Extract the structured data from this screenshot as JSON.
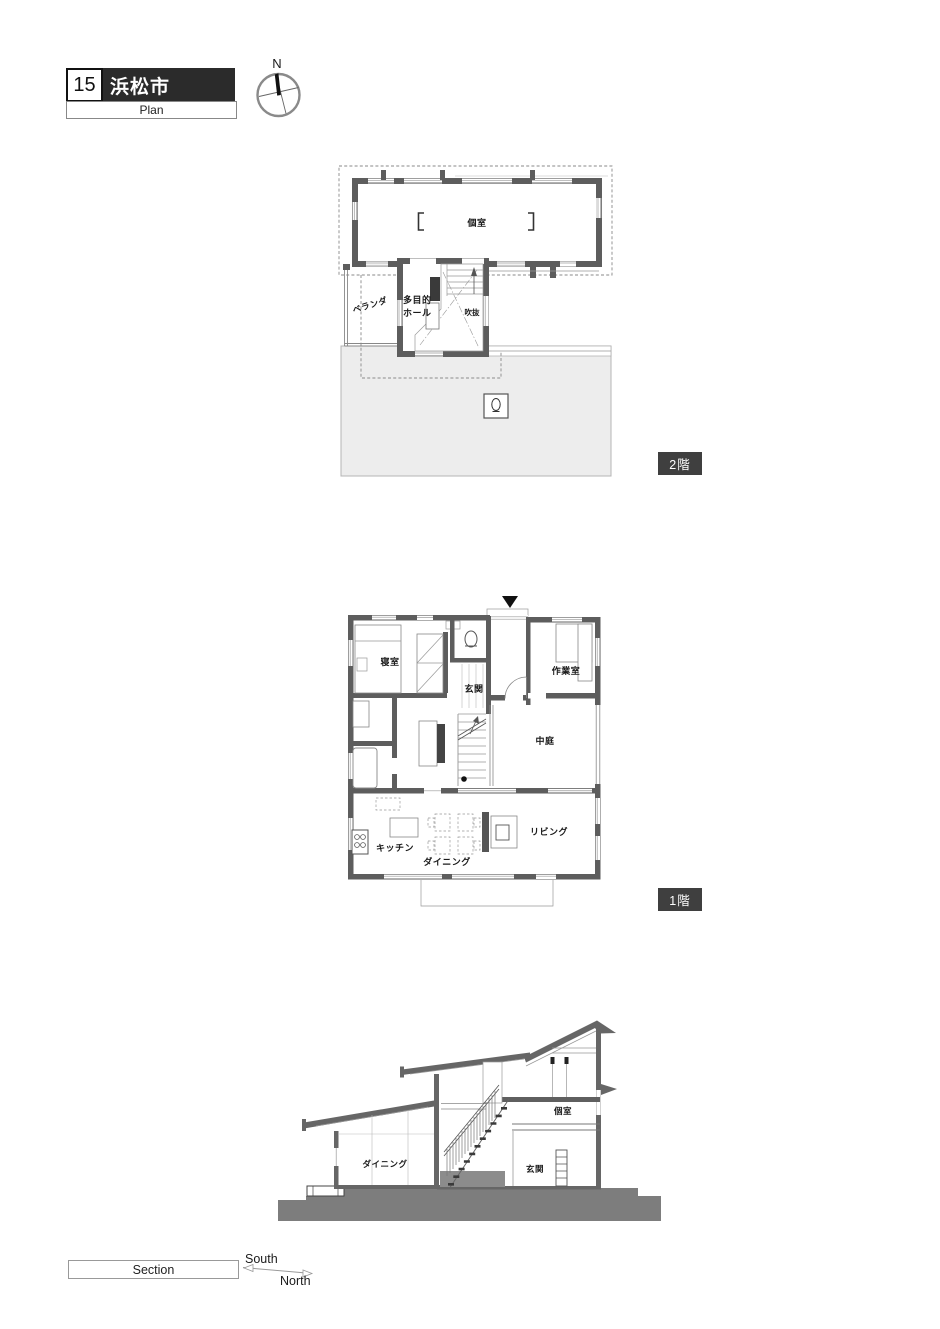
{
  "title": {
    "number": "15",
    "city": "浜松市",
    "sheet": "Plan"
  },
  "compass": {
    "north": "N"
  },
  "floor2": {
    "badge": "2階",
    "rooms": {
      "private_room": "個室",
      "hall_line1": "多目的",
      "hall_line2": "ホール",
      "void": "吹抜",
      "veranda": "ベランダ"
    }
  },
  "floor1": {
    "badge": "1階",
    "rooms": {
      "bedroom": "寝室",
      "entrance": "玄関",
      "workroom": "作業室",
      "courtyard": "中庭",
      "kitchen": "キッチン",
      "dining": "ダイニング",
      "living": "リビング"
    }
  },
  "section": {
    "sheet": "Section",
    "south": "South",
    "north": "North",
    "rooms": {
      "dining": "ダイニング",
      "entrance": "玄関",
      "private_room": "個室"
    }
  },
  "colors": {
    "wall": "#5d5d5d",
    "roof_shade": "#ededed",
    "ground": "#7d7d7d",
    "badge_bg": "#3f3f3f",
    "header_bg": "#2b2b2b"
  }
}
